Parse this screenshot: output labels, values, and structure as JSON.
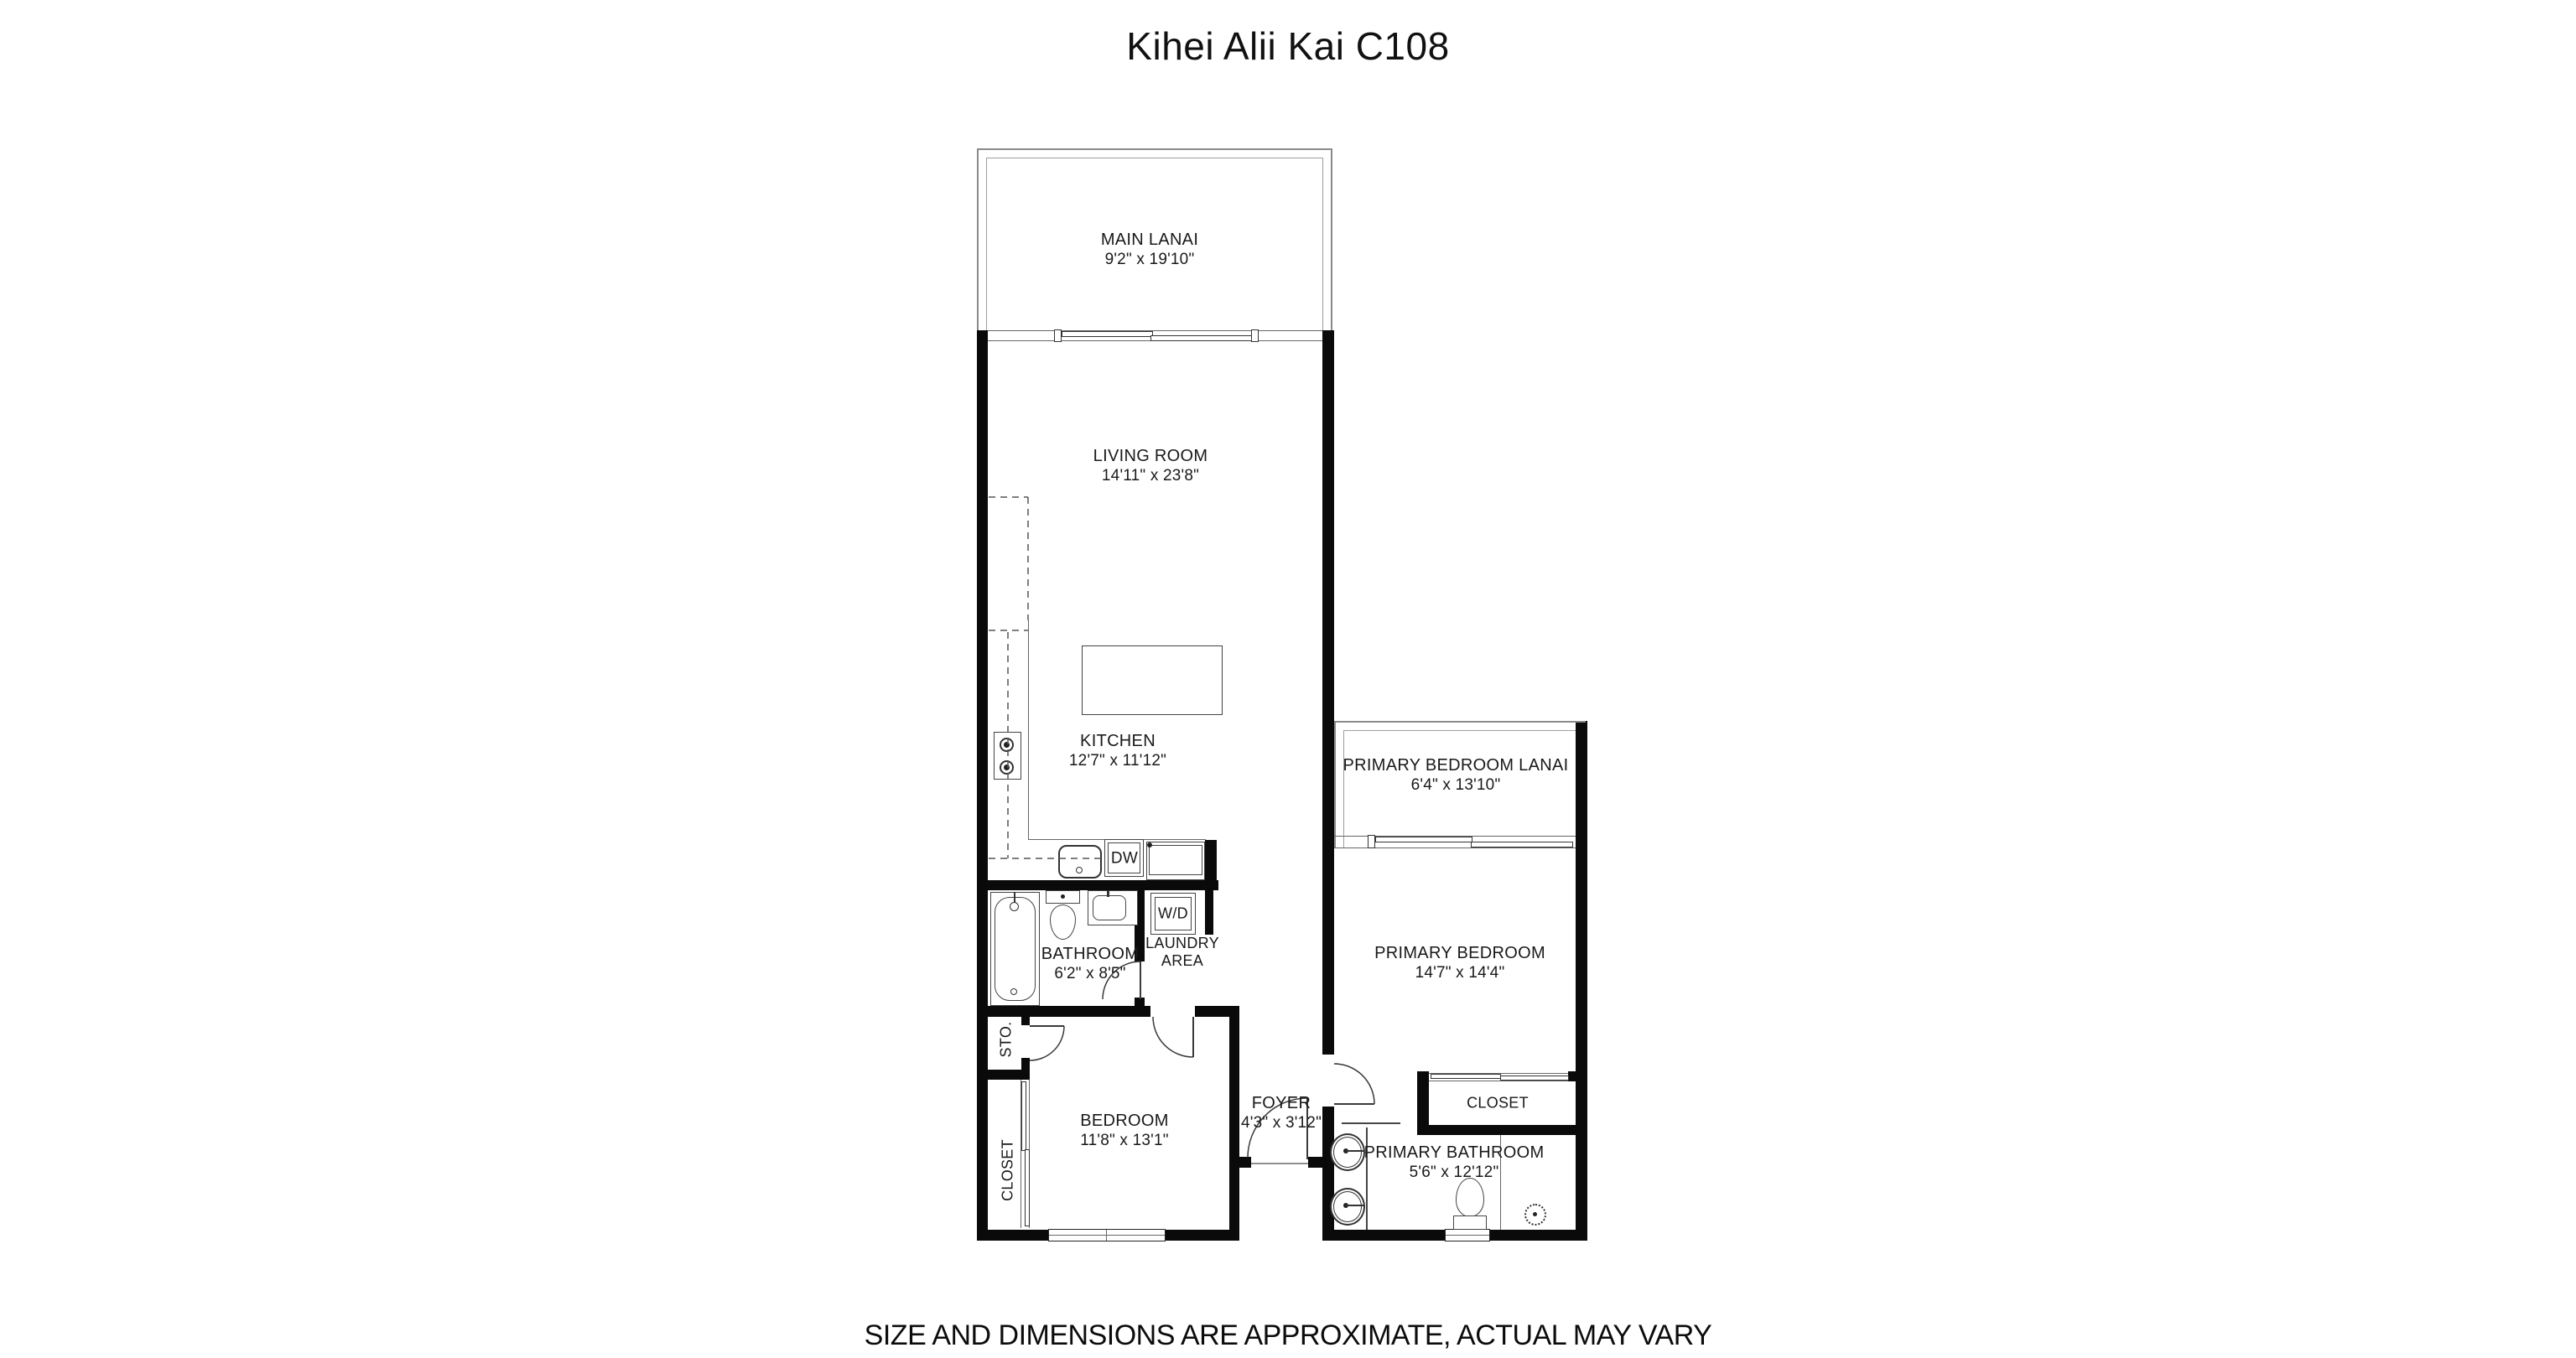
{
  "title": "Kihei Alii Kai C108",
  "disclaimer": "SIZE AND DIMENSIONS ARE APPROXIMATE, ACTUAL MAY VARY",
  "rooms": {
    "main_lanai": {
      "name": "MAIN LANAI",
      "dims": "9'2\" x 19'10\""
    },
    "living_room": {
      "name": "LIVING ROOM",
      "dims": "14'11\" x 23'8\""
    },
    "kitchen": {
      "name": "KITCHEN",
      "dims": "12'7\" x 11'12\""
    },
    "bathroom": {
      "name": "BATHROOM",
      "dims": "6'2\" x 8'5\""
    },
    "laundry": {
      "line1": "LAUNDRY",
      "line2": "AREA"
    },
    "bedroom": {
      "name": "BEDROOM",
      "dims": "11'8\" x 13'1\""
    },
    "foyer": {
      "name": "FOYER",
      "dims": "4'3\" x 3'12\""
    },
    "primary_bedroom_lanai": {
      "name": "PRIMARY BEDROOM LANAI",
      "dims": "6'4\" x 13'10\""
    },
    "primary_bedroom": {
      "name": "PRIMARY BEDROOM",
      "dims": "14'7\" x 14'4\""
    },
    "primary_bathroom": {
      "name": "PRIMARY BATHROOM",
      "dims": "5'6\" x 12'12\""
    },
    "primary_closet": {
      "name": "CLOSET"
    },
    "bedroom_closet": {
      "name": "CLOSET"
    },
    "storage": {
      "name": "STO."
    }
  },
  "appliances": {
    "washer_dryer": "W/D",
    "dishwasher": "DW"
  },
  "colors": {
    "wall": "#0a0a0a",
    "thin_line": "#666666",
    "lanai_wall": "#8a8a8a",
    "background": "#ffffff"
  }
}
